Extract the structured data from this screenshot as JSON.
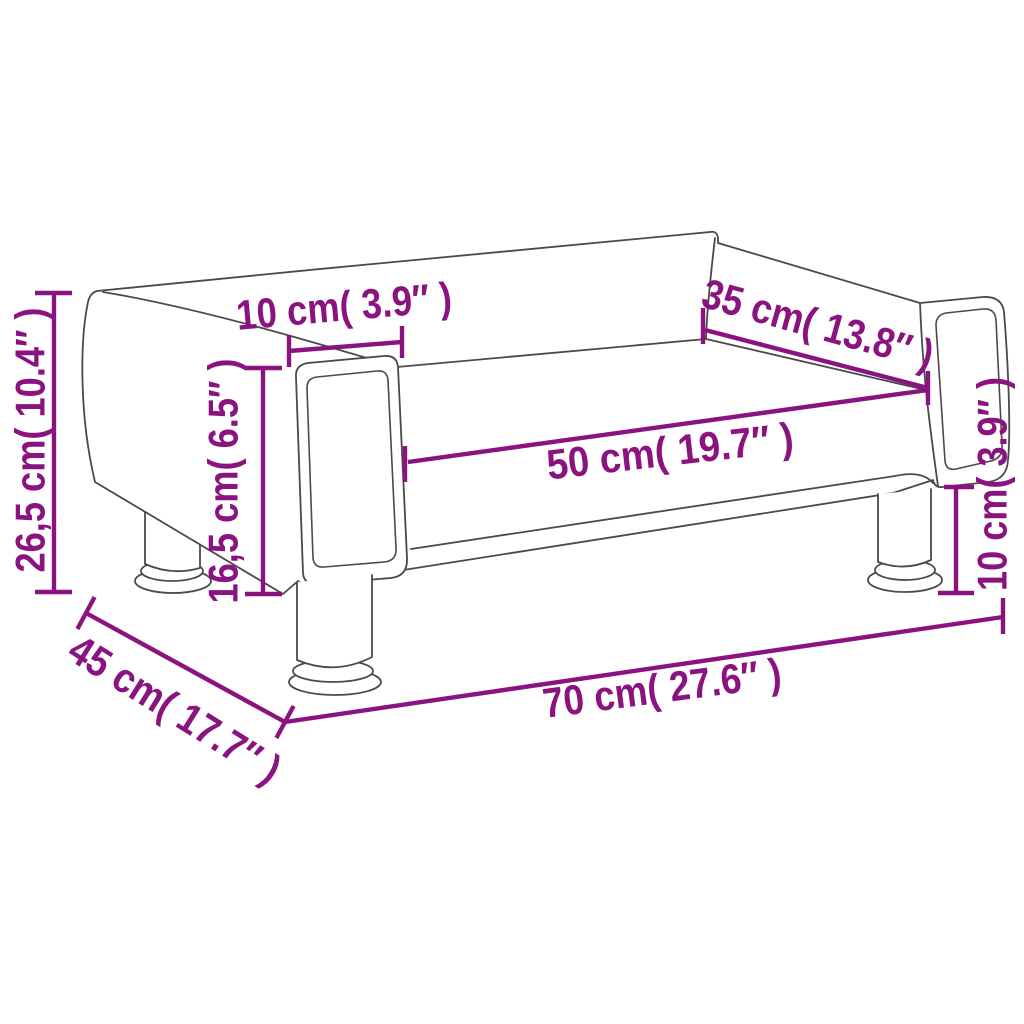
{
  "page": {
    "background": "#ffffff"
  },
  "diagram": {
    "kind": "product-dimension-diagram",
    "subject": "kids-sofa-line-drawing",
    "accent_color": "#8B1380",
    "outline_color": "#4A4A4A",
    "labels": {
      "overall_height": "26,5 cm( 10.4″ )",
      "armrest_height": "16,5 cm( 6.5″ )",
      "armrest_width": "10 cm( 3.9″ )",
      "backrest_width": "35 cm( 13.8″ )",
      "seat_width": "50 cm( 19.7″ )",
      "leg_height": "10 cm( 3.9″ )",
      "depth": "45 cm( 17.7″ )",
      "overall_width": "70 cm( 27.6″ )"
    }
  }
}
